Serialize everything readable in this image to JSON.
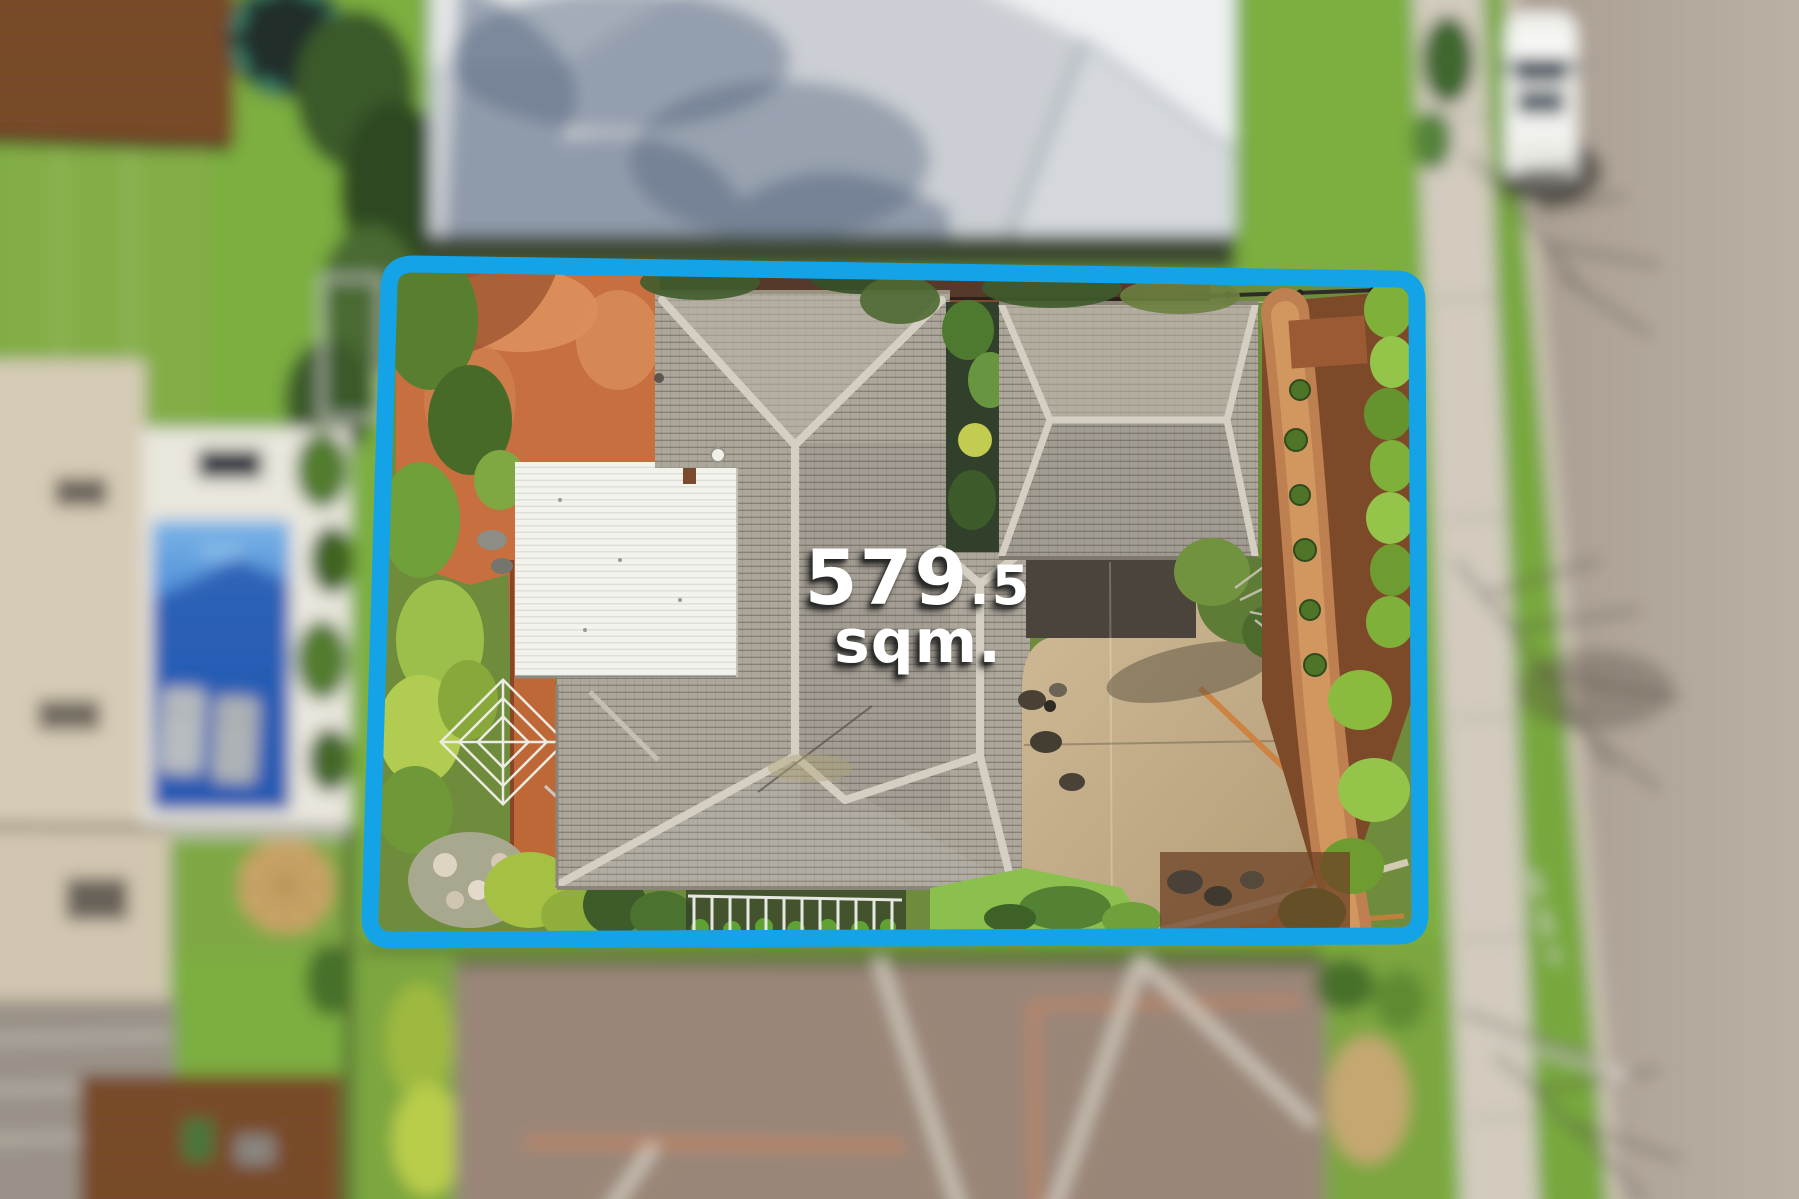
{
  "image": {
    "kind": "aerial-drone-photo",
    "width_px": 1799,
    "height_px": 1199,
    "focus_note": "property inside blue boundary rendered sharp, surroundings blurred"
  },
  "overlay": {
    "area_value": "579.5",
    "area_whole": "579",
    "area_fraction": ".5",
    "unit_label": "sqm.",
    "boundary_shape": "rounded-rectangle outline around property lot"
  },
  "colors": {
    "boundary_blue": "#15A3E8",
    "label_text": "#FFFFFF",
    "label_shadow": "rgba(30,30,30,0.85)",
    "road": "#AFA497",
    "footpath": "#D2CBBE",
    "grass": "#7CAE3F",
    "pool_water": "#3E82D4",
    "pool_deck": "#E9E6DC",
    "gray_roof": "#ACA69B",
    "white_roof": "#F3F3EE",
    "orange_paving": "#C76F3E",
    "driveway": "#C3AD89",
    "mulch_bed": "#7C4A28",
    "neighbor_roof_bottom": "#9D8A7C",
    "neighbor_roof_top": "#C7CBD0"
  },
  "scene": {
    "features": [
      "main-house-hip-roof",
      "white-carport-roof",
      "garage-hip-roof",
      "orange-brick-paving",
      "rotary-clothesline",
      "concrete-driveway",
      "mulch-garden-path",
      "hedge-row",
      "swimming-pool",
      "pool-deck",
      "trampoline",
      "parked-white-car",
      "street-road",
      "footpath",
      "nature-strip",
      "tree-shadows",
      "neighbor-tiled-roofs"
    ]
  }
}
